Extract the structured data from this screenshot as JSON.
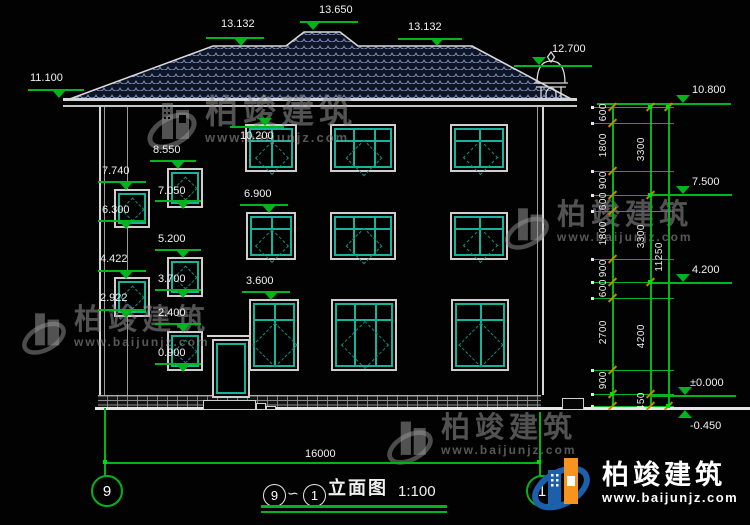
{
  "watermark": {
    "brand": "柏竣建筑",
    "url": "www.baijunjz.com"
  },
  "annotations": {
    "elevations": {
      "m13650": "13.650",
      "m13132L": "13.132",
      "m13132R": "13.132",
      "m12700": "12.700",
      "m11100": "11.100",
      "m10800": "10.800",
      "m10200": "10.200",
      "m8550": "8.550",
      "m7740": "7.740",
      "m7500": "7.500",
      "m7050": "7.050",
      "m6900": "6.900",
      "m6300": "6.300",
      "m5200": "5.200",
      "m4422": "4.422",
      "m4200": "4.200",
      "m3700": "3.700",
      "m3600": "3.600",
      "m2922": "2.922",
      "m2400": "2.400",
      "m0900": "0.900",
      "m0000": "±0.000",
      "mneg0450": "-0.450"
    }
  },
  "dims": {
    "right_col1": [
      "600",
      "1800",
      "900",
      "600",
      "1800",
      "900",
      "600",
      "2700",
      "900"
    ],
    "right_col2": [
      "3300",
      "3300",
      "4200",
      "450"
    ],
    "right_col3": [
      "11250"
    ],
    "bottom_width": "16000"
  },
  "axes": {
    "left": "9",
    "right": "1"
  },
  "titlebar": {
    "axis_start": "9",
    "tilde": "∽",
    "axis_end": "1",
    "name": "立面图",
    "scale": "1:100"
  },
  "colors": {
    "annotation_green": "#00b41e",
    "window_teal": "#14b39a",
    "tick_orange": "#c08a00",
    "logo_orange": "#f7941d",
    "logo_blue": "#1b5fad"
  }
}
